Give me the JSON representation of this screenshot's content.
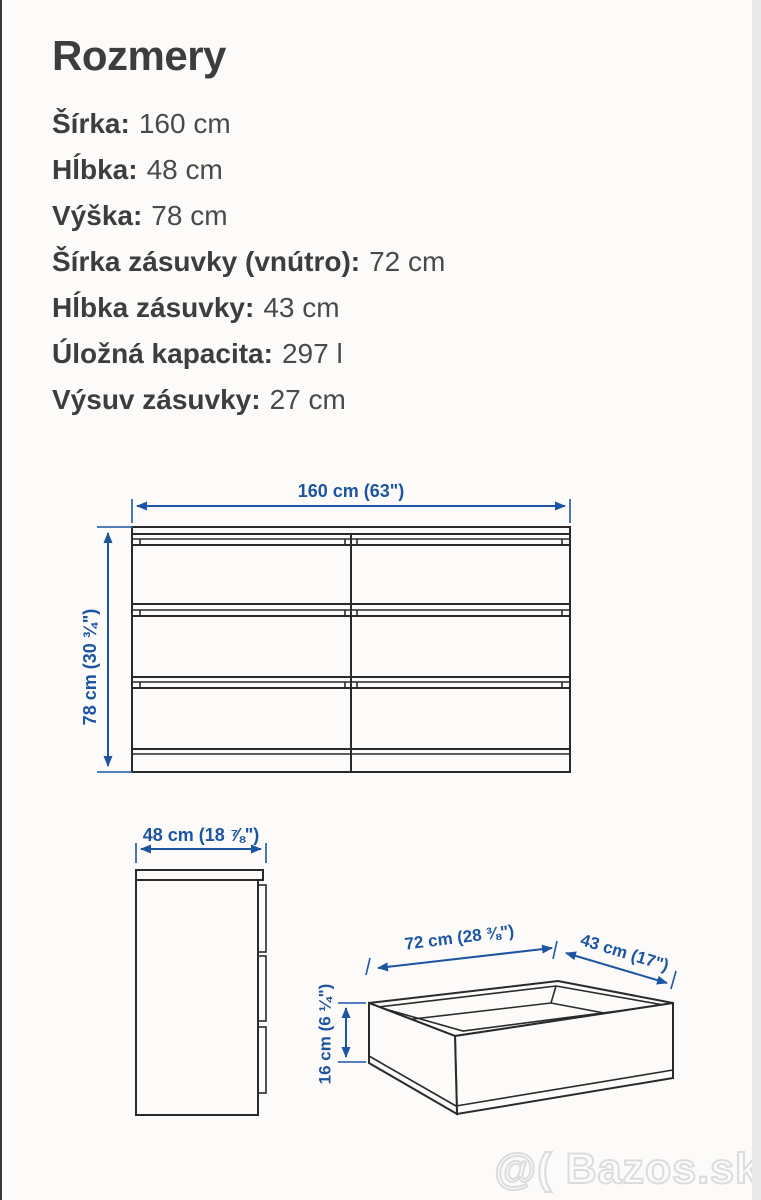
{
  "page": {
    "title": "Rozmery",
    "watermark": "@( Bazos.sk",
    "accent_blue": "#1d55a3",
    "line_color": "#2a2a2a"
  },
  "specs": [
    {
      "label": "Šírka:",
      "value": "160 cm"
    },
    {
      "label": "Hĺbka:",
      "value": "48 cm"
    },
    {
      "label": "Výška:",
      "value": "78 cm"
    },
    {
      "label": "Šírka zásuvky (vnútro):",
      "value": "72 cm"
    },
    {
      "label": "Hĺbka zásuvky:",
      "value": "43 cm"
    },
    {
      "label": "Úložná kapacita:",
      "value": "297 l"
    },
    {
      "label": "Výsuv zásuvky:",
      "value": "27 cm"
    }
  ],
  "diagram": {
    "front_view": {
      "width_label": "160 cm (63\")",
      "height_label": "78 cm (30 ¾\")"
    },
    "side_view": {
      "depth_label": "48 cm (18 ⅞\")"
    },
    "drawer_view": {
      "width_label": "72 cm (28 ⅜\")",
      "depth_label": "43 cm (17\")",
      "height_label": "16 cm (6 ¼\")"
    }
  }
}
